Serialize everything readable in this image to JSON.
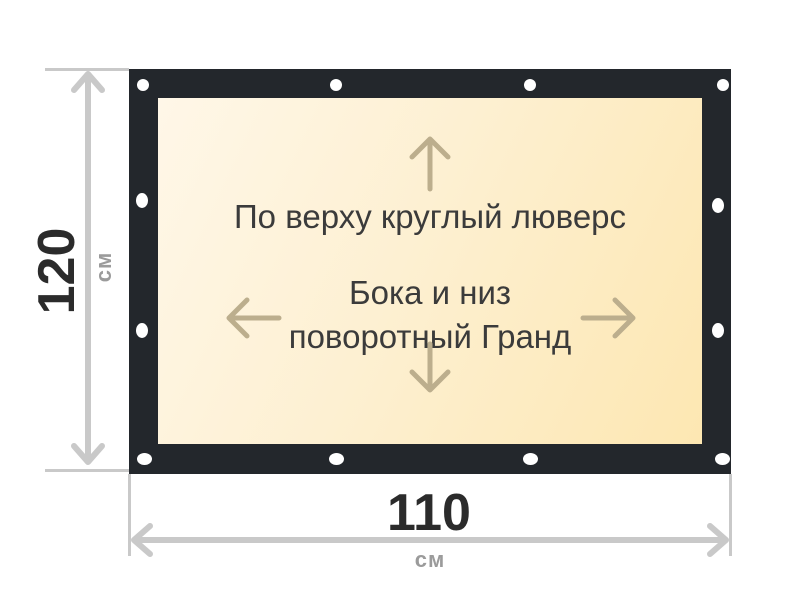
{
  "banner": {
    "top_note": "По верху круглый люверс",
    "center_note_line1": "Бока и низ",
    "center_note_line2": "поворотный Гранд",
    "colors": {
      "frame": "#23272c",
      "surface_gradient_start": "#fff7e8",
      "surface_gradient_end": "#fde7b2",
      "grommet": "#ffffff",
      "content_arrow": "#bcae8d",
      "note_text": "#3b3b3b"
    }
  },
  "dimensions": {
    "height": {
      "value": "120",
      "unit": "см"
    },
    "width": {
      "value": "110",
      "unit": "см"
    },
    "colors": {
      "line": "#c9c9c9",
      "value_text": "#2b2b2b",
      "unit_text": "#9b9b9b"
    }
  },
  "icons": {
    "grommet": "white-circle",
    "arrow_up": "↑",
    "arrow_down": "↓",
    "arrow_left": "←",
    "arrow_right": "→",
    "dimension_arrow_vertical": "↕",
    "dimension_arrow_horizontal": "↔"
  }
}
